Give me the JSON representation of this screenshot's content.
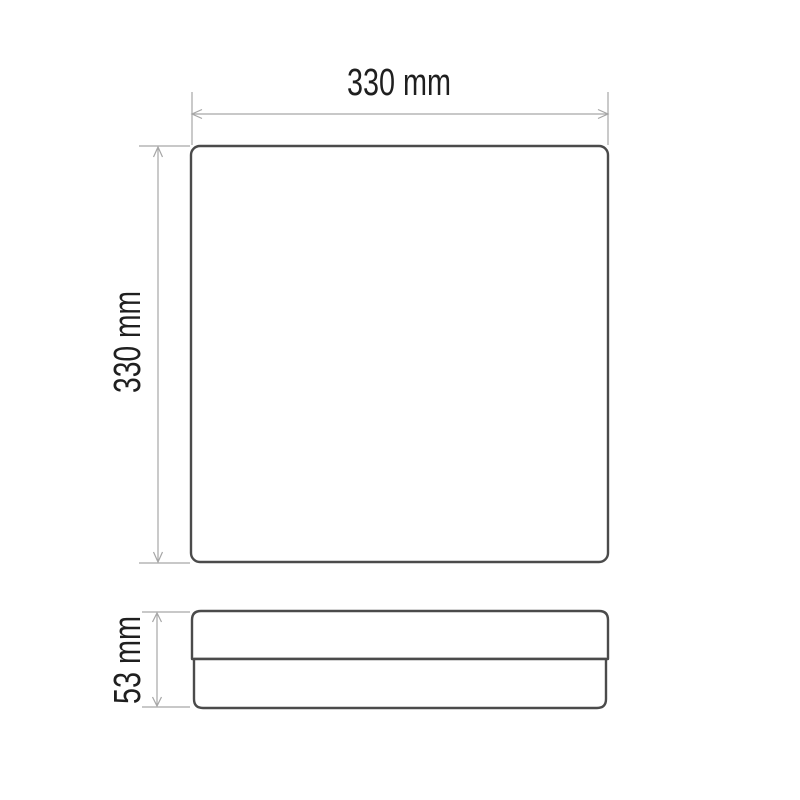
{
  "drawing": {
    "labels": {
      "top_width": "330 mm",
      "left_height": "330 mm",
      "side_depth": "53 mm"
    },
    "dimensions_mm": {
      "width": 330,
      "height": 330,
      "depth": 53
    },
    "colors": {
      "background": "#ffffff",
      "outline": "#4b4b4b",
      "dimension": "#a6a6a6",
      "label": "#1f1f1f"
    }
  }
}
